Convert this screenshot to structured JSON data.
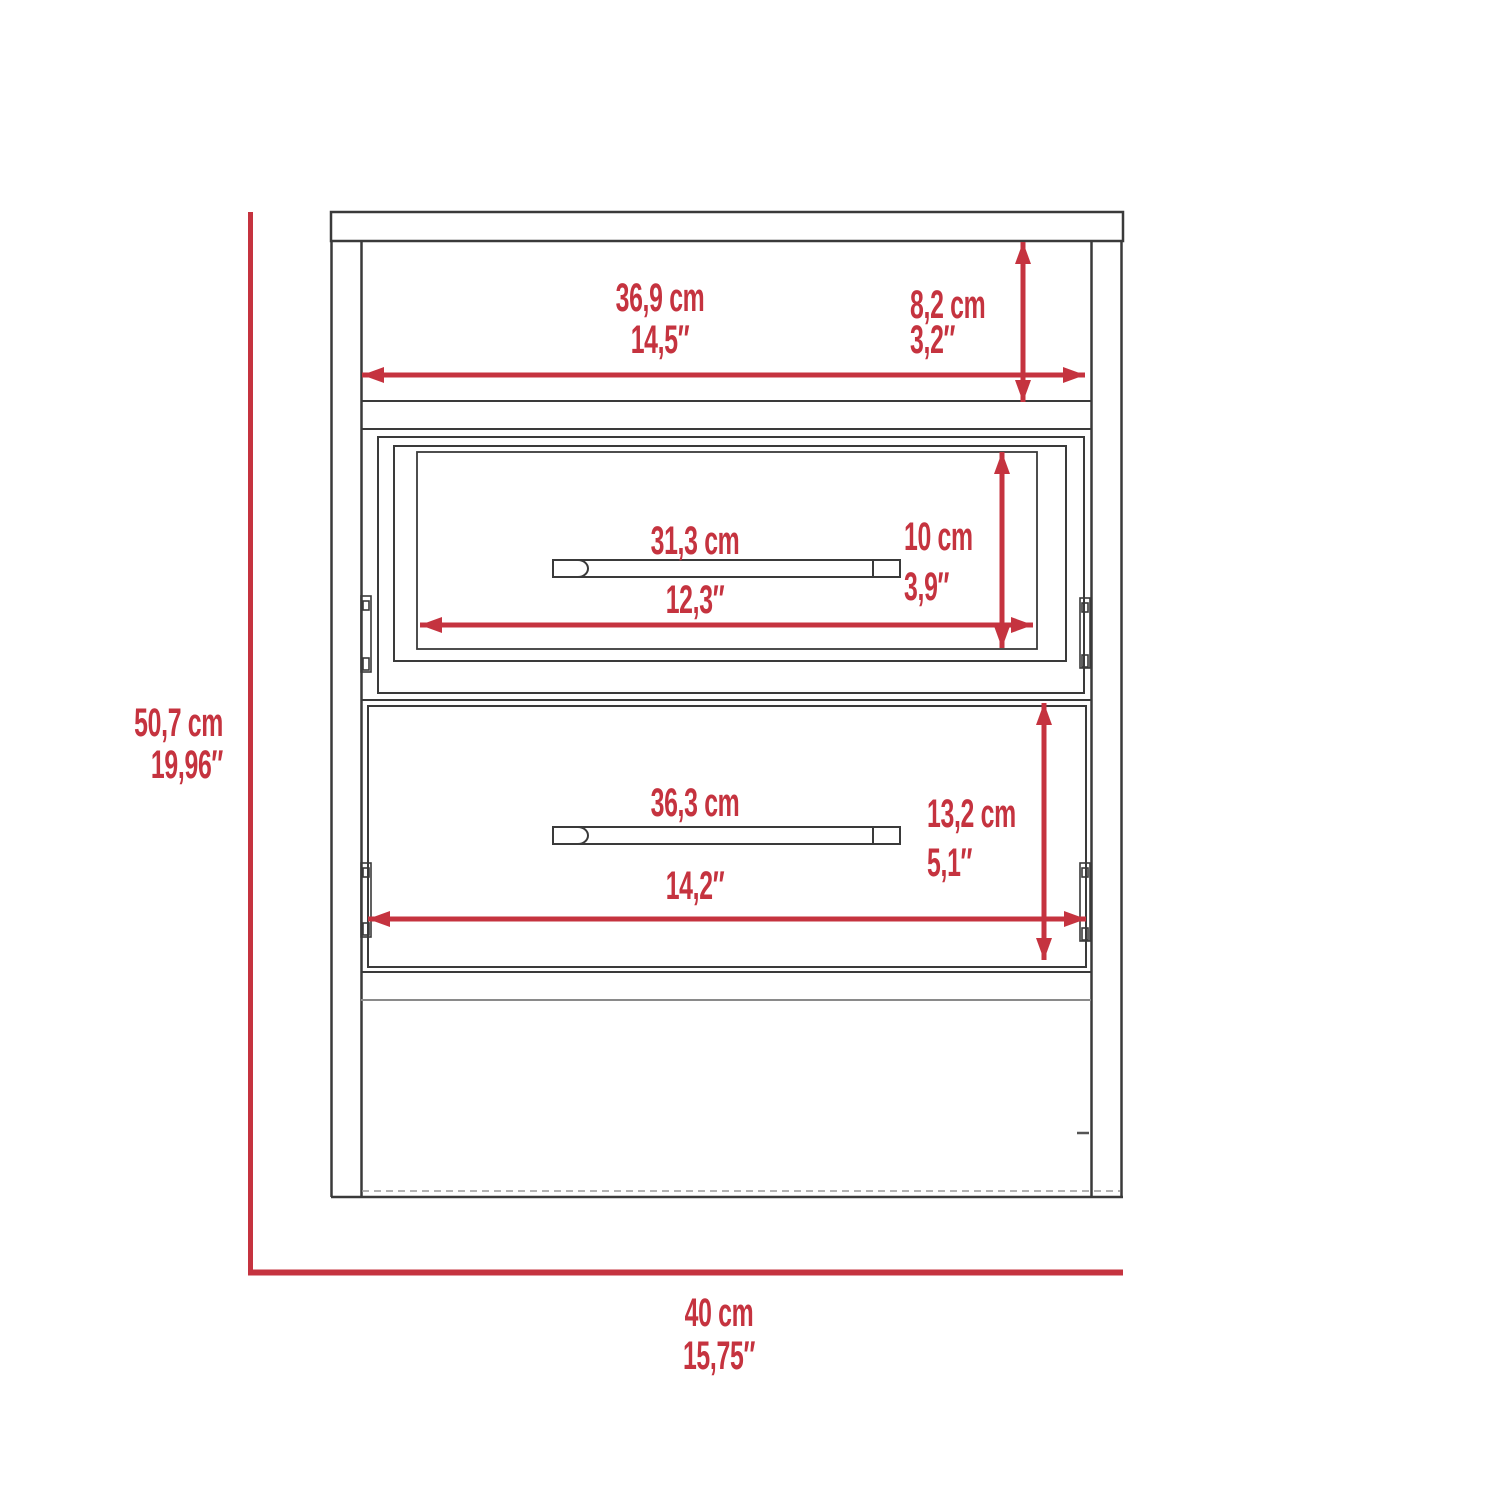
{
  "palette": {
    "dimension_red": "#C5333F",
    "line_black": "#3a3a3a",
    "line_gray": "#8a8a8a"
  },
  "dimensions": {
    "overall_height": {
      "cm": "50,7 cm",
      "in": "19,96″"
    },
    "overall_width": {
      "cm": "40 cm",
      "in": "15,75″"
    },
    "top_shelf_width": {
      "cm": "36,9 cm",
      "in": "14,5″"
    },
    "top_shelf_height": {
      "cm": "8,2 cm",
      "in": "3,2″"
    },
    "drawer1_width": {
      "cm": "31,3 cm",
      "in": "12,3″"
    },
    "drawer1_height": {
      "cm": "10 cm",
      "in": "3,9″"
    },
    "drawer2_width": {
      "cm": "36,3 cm",
      "in": "14,2″"
    },
    "drawer2_height": {
      "cm": "13,2 cm",
      "in": "5,1″"
    }
  }
}
